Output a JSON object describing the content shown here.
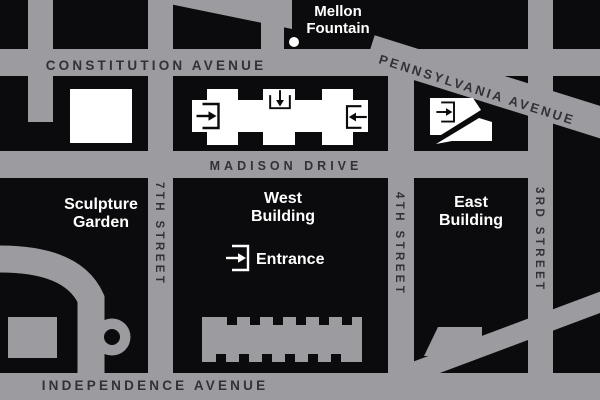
{
  "map": {
    "title": "National Gallery of Art area map",
    "colors": {
      "background": "#0b0b0d",
      "street": "#9c9ca0",
      "street_text": "#323236",
      "building_footprint": "#ffffff",
      "label_text": "#ffffff"
    },
    "streets": {
      "constitution": "CONSTITUTION AVENUE",
      "pennsylvania": "PENNSYLVANIA AVENUE",
      "madison": "MADISON DRIVE",
      "independence": "INDEPENDENCE AVENUE",
      "seventh": "7TH STREET",
      "fourth": "4TH STREET",
      "third": "3RD STREET"
    },
    "labels": {
      "mellon": [
        "Mellon",
        "Fountain"
      ],
      "sculpture_garden": [
        "Sculpture",
        "Garden"
      ],
      "west_building": [
        "West",
        "Building"
      ],
      "east_building": [
        "East",
        "Building"
      ],
      "entrance": "Entrance"
    }
  }
}
